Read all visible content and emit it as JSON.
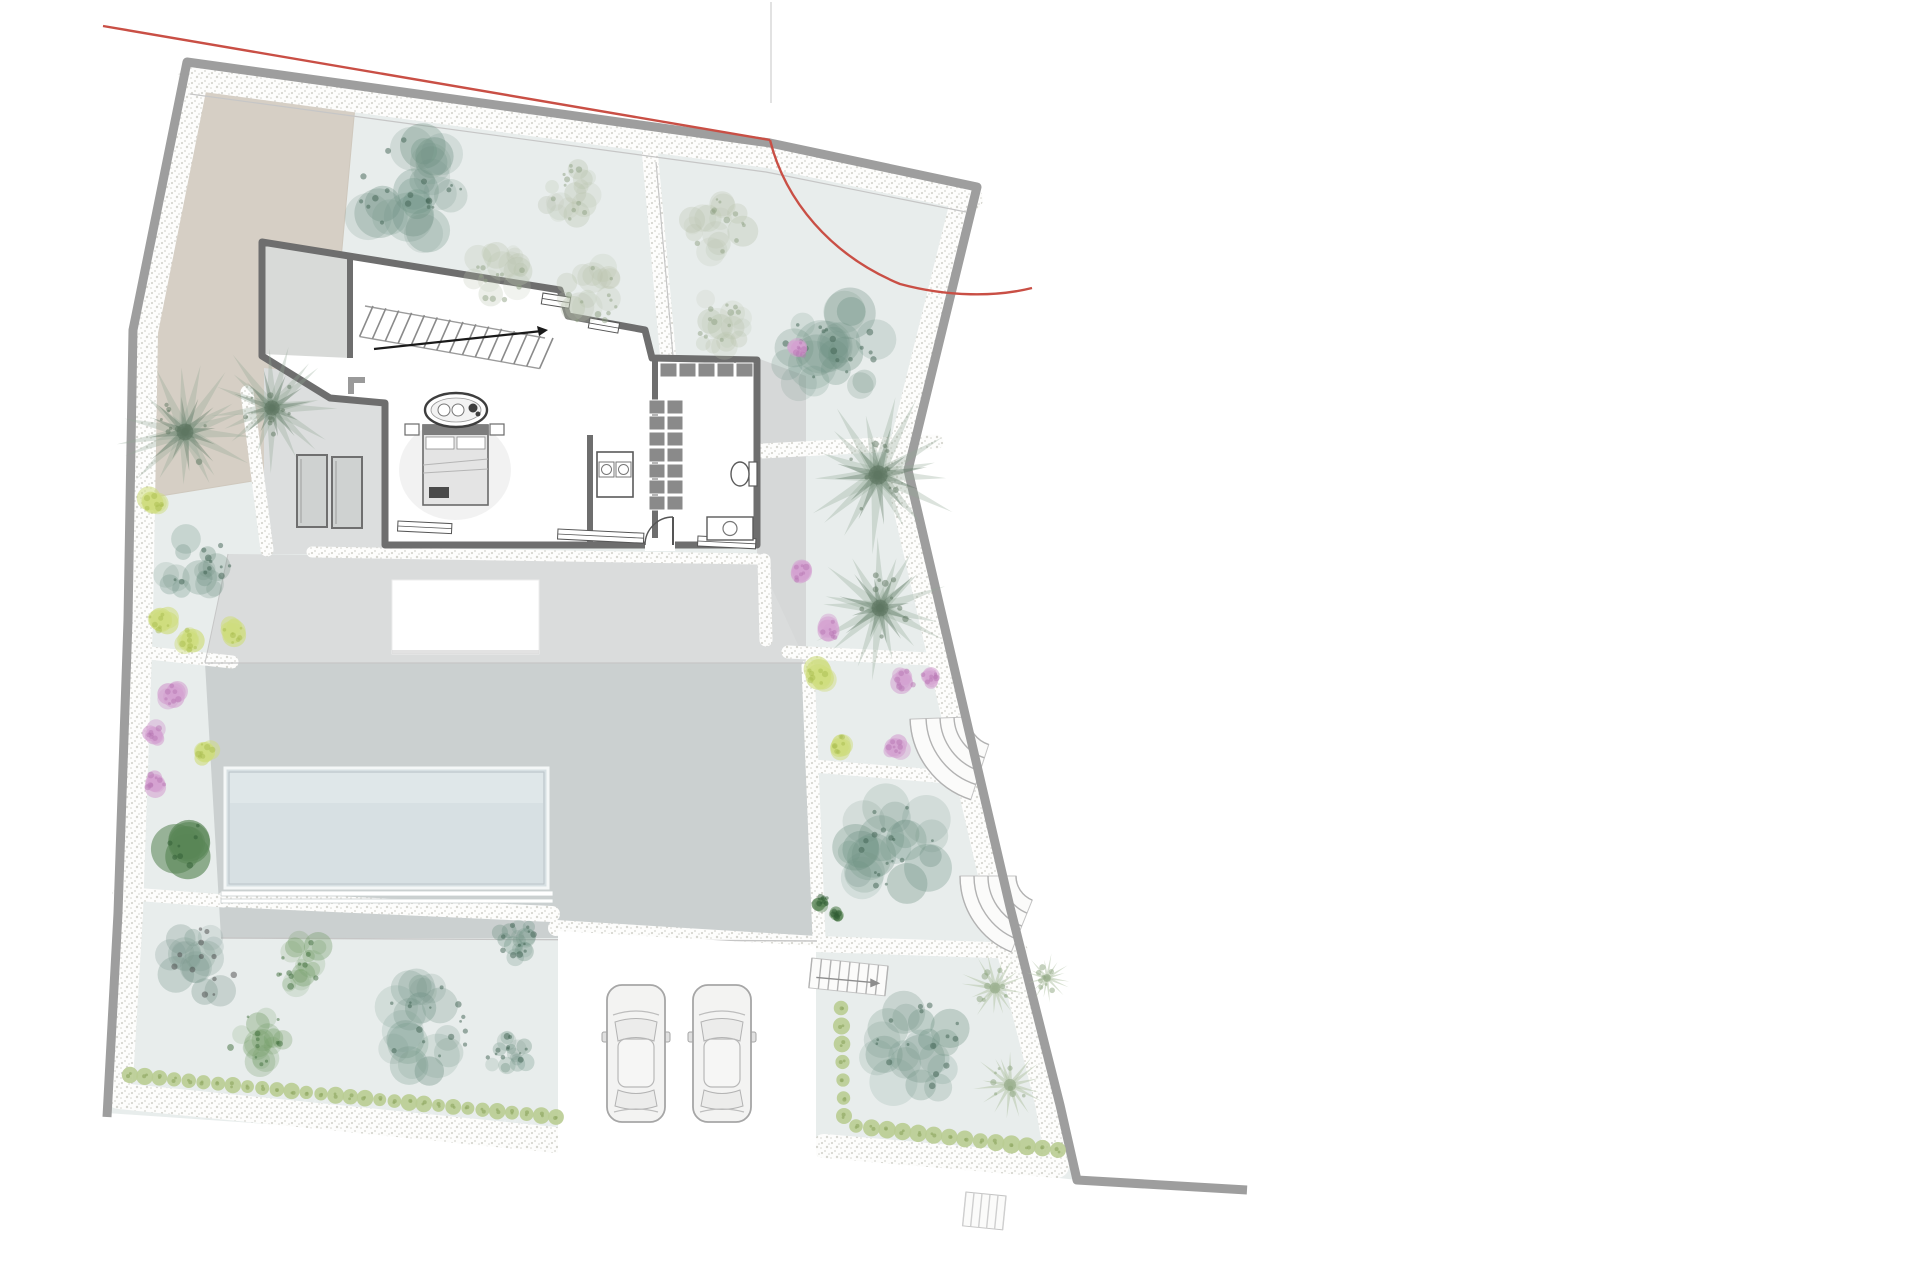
{
  "meta": {
    "title": "villa-site-plan",
    "canvas": {
      "w": 1920,
      "h": 1280
    }
  },
  "colors": {
    "page": "#ffffff",
    "lawn": "#e8edec",
    "beige": "#d6cfc5",
    "beige_edge": "#cfc8bd",
    "terrace": "#dadcdc",
    "porch": "#dcdede",
    "east_strip": "#d6d8d8",
    "slab": "#cbd0d0",
    "pool_fill": "#d7e0e3",
    "pool_light": "#e3ebed",
    "pool_line": "#b9c3c6",
    "pool_coping": "#c9cfcf",
    "wall": "#9e9e9e",
    "thin": "#c6c6c6",
    "house_wall": "#6e6e6e",
    "furniture": "#565656",
    "closet": "#8a8a8a",
    "red": "#c94f45",
    "gravel_dot": "#d6d6d0",
    "stair_line": "#b2b2b2",
    "car_body": "#f3f3f2",
    "car_line": "#a6a6a6",
    "teal": "#6e9183",
    "teal_dark": "#3f6152",
    "tealgray": "#7b988e",
    "sage": "#b9c3ad",
    "sage_dark": "#8fa183",
    "green": "#6f9a62",
    "green_dark": "#3f6e3c",
    "darkgreen": "#5a8657",
    "darkgreen_dark": "#2f5c33",
    "palm": "#93a796",
    "palm_dark": "#5d7560",
    "palmetto": "#b7c7ab",
    "palmetto_dark": "#8ba37e",
    "yellow": "#cfdd7e",
    "yellow_dark": "#a9bd4f",
    "magenta": "#d4a2d1",
    "magenta_dark": "#b877b4",
    "hedge": "#b9cc92",
    "hedge_dark": "#93ab66"
  },
  "plot": {
    "outline": [
      [
        187,
        62
      ],
      [
        770,
        143
      ],
      [
        977,
        187
      ],
      [
        908,
        470
      ],
      [
        1010,
        907
      ],
      [
        1060,
        1105
      ],
      [
        1077,
        1180
      ],
      [
        826,
        1152
      ],
      [
        558,
        1144
      ],
      [
        107,
        1113
      ],
      [
        118,
        913
      ],
      [
        128,
        620
      ],
      [
        133,
        330
      ]
    ],
    "wall_path": [
      [
        107,
        1117
      ],
      [
        118,
        913
      ],
      [
        128,
        620
      ],
      [
        133,
        330
      ],
      [
        187,
        62
      ],
      [
        770,
        143
      ],
      [
        977,
        187
      ],
      [
        908,
        470
      ],
      [
        1010,
        907
      ],
      [
        1060,
        1105
      ],
      [
        1077,
        1180
      ],
      [
        1247,
        1190
      ]
    ],
    "red_segment": [
      [
        103,
        26
      ],
      [
        770,
        140
      ]
    ],
    "red_curve": "M770,140 C785,200 830,255 900,284 C948,297 996,297 1032,288"
  },
  "areas": {
    "beige": [
      [
        200,
        67
      ],
      [
        357,
        84
      ],
      [
        330,
        380
      ],
      [
        308,
        472
      ],
      [
        148,
        498
      ],
      [
        133,
        335
      ]
    ],
    "upper_terrace": [
      [
        228,
        554
      ],
      [
        800,
        560
      ],
      [
        806,
        663
      ],
      [
        205,
        663
      ]
    ],
    "west_porch": [
      [
        264,
        368
      ],
      [
        383,
        380
      ],
      [
        383,
        554
      ],
      [
        264,
        554
      ]
    ],
    "east_strip": [
      [
        757,
        358
      ],
      [
        806,
        376
      ],
      [
        806,
        662
      ],
      [
        757,
        556
      ]
    ],
    "slab": [
      [
        205,
        663
      ],
      [
        806,
        663
      ],
      [
        817,
        938
      ],
      [
        221,
        938
      ]
    ],
    "parking": [
      [
        558,
        931
      ],
      [
        816,
        946
      ],
      [
        816,
        1245
      ],
      [
        558,
        1245
      ]
    ]
  },
  "pool": {
    "x": 225,
    "y": 768,
    "w": 323,
    "h": 120,
    "coping": [
      [
        221,
        891,
        332,
        5
      ],
      [
        221,
        899,
        332,
        4
      ]
    ]
  },
  "pergola": {
    "x": 392,
    "y": 580,
    "w": 147,
    "h": 74
  },
  "gravel_bands": [
    {
      "pts": [
        [
          190,
          78
        ],
        [
          768,
          156
        ],
        [
          971,
          199
        ]
      ],
      "w": 24
    },
    {
      "pts": [
        [
          197,
          80
        ],
        [
          147,
          332
        ],
        [
          142,
          620
        ],
        [
          132,
          913
        ],
        [
          121,
          1098
        ]
      ],
      "w": 22
    },
    {
      "pts": [
        [
          119,
          1096
        ],
        [
          556,
          1140
        ]
      ],
      "w": 26
    },
    {
      "pts": [
        [
          962,
          198
        ],
        [
          895,
          468
        ],
        [
          996,
          905
        ],
        [
          1046,
          1103
        ],
        [
          1057,
          1166
        ]
      ],
      "w": 22
    },
    {
      "pts": [
        [
          1057,
          1166
        ],
        [
          824,
          1146
        ]
      ],
      "w": 24
    },
    {
      "pts": [
        [
          650,
          154
        ],
        [
          668,
          356
        ]
      ],
      "w": 16
    },
    {
      "pts": [
        [
          655,
          372
        ],
        [
          742,
          452
        ],
        [
          936,
          442
        ]
      ],
      "w": 15
    },
    {
      "pts": [
        [
          788,
          652
        ],
        [
          950,
          660
        ]
      ],
      "w": 13
    },
    {
      "pts": [
        [
          813,
          766
        ],
        [
          973,
          779
        ]
      ],
      "w": 13
    },
    {
      "pts": [
        [
          556,
          928
        ],
        [
          816,
          944
        ],
        [
          1020,
          951
        ]
      ],
      "w": 16
    },
    {
      "pts": [
        [
          225,
          899
        ],
        [
          552,
          914
        ]
      ],
      "w": 16
    },
    {
      "pts": [
        [
          140,
          652
        ],
        [
          232,
          662
        ]
      ],
      "w": 13
    },
    {
      "pts": [
        [
          119,
          893
        ],
        [
          224,
          901
        ]
      ],
      "w": 13
    },
    {
      "pts": [
        [
          312,
          552
        ],
        [
          757,
          559
        ]
      ],
      "w": 11
    },
    {
      "pts": [
        [
          764,
          560
        ],
        [
          766,
          640
        ]
      ],
      "w": 13
    },
    {
      "pts": [
        [
          808,
          666
        ],
        [
          819,
          938
        ]
      ],
      "w": 13
    },
    {
      "pts": [
        [
          247,
          392
        ],
        [
          267,
          550
        ]
      ],
      "w": 13
    }
  ],
  "thin_lines": [
    {
      "pts": [
        [
          190,
          94
        ],
        [
          766,
          172
        ],
        [
          966,
          212
        ]
      ],
      "w": 1.2
    },
    {
      "pts": [
        [
          656,
          162
        ],
        [
          673,
          356
        ]
      ],
      "w": 1.2
    },
    {
      "pts": [
        [
          205,
          663
        ],
        [
          806,
          663
        ]
      ],
      "w": 1.2
    },
    {
      "pts": [
        [
          221,
          938
        ],
        [
          817,
          941
        ]
      ],
      "w": 1.4
    },
    {
      "pts": [
        [
          228,
          554
        ],
        [
          205,
          663
        ]
      ],
      "w": 1.0
    },
    {
      "pts": [
        [
          567,
          947
        ],
        [
          567,
          1130
        ]
      ],
      "w": 1.4
    }
  ],
  "house": {
    "outline": [
      [
        262,
        242
      ],
      [
        560,
        290
      ],
      [
        568,
        316
      ],
      [
        645,
        330
      ],
      [
        652,
        358
      ],
      [
        757,
        360
      ],
      [
        757,
        545
      ],
      [
        385,
        545
      ],
      [
        385,
        403
      ],
      [
        330,
        398
      ],
      [
        262,
        356
      ]
    ],
    "garage": [
      [
        262,
        242
      ],
      [
        350,
        256
      ],
      [
        350,
        358
      ],
      [
        262,
        354
      ]
    ],
    "partitions": [
      [
        [
          350,
          256
        ],
        [
          350,
          358
        ]
      ],
      [
        [
          655,
          360
        ],
        [
          655,
          430
        ]
      ],
      [
        [
          655,
          462
        ],
        [
          655,
          545
        ]
      ],
      [
        [
          590,
          435
        ],
        [
          590,
          545
        ]
      ]
    ],
    "stair": {
      "a": [
        365,
        306
      ],
      "b": [
        545,
        338
      ],
      "w": 31,
      "treads": 14,
      "lean": 8,
      "handrail": [
        [
          374,
          349
        ],
        [
          542,
          331
        ]
      ],
      "arrow": [
        [
          548,
          330
        ],
        [
          537,
          326
        ],
        [
          539,
          336
        ]
      ]
    },
    "north_windows": [
      {
        "x": 543,
        "y": 293,
        "w": 28,
        "h": 11,
        "rot": 9
      },
      {
        "x": 590,
        "y": 318,
        "w": 30,
        "h": 10,
        "rot": 10
      }
    ],
    "south_windows": [
      {
        "x": 398,
        "y": 521,
        "w": 54,
        "h": 10,
        "rot": 2.8
      },
      {
        "x": 558,
        "y": 529,
        "w": 86,
        "h": 10,
        "rot": 2.8
      },
      {
        "x": 698,
        "y": 536,
        "w": 58,
        "h": 10,
        "rot": 2.8
      }
    ],
    "door": {
      "gap": [
        645,
        538,
        30,
        13
      ],
      "arc": "M645,545 A28,28 0 0 1 673,517",
      "leaf": [
        [
          673,
          545
        ],
        [
          673,
          517
        ]
      ]
    },
    "bathtub": {
      "cx": 456,
      "cy": 410,
      "rx": 31,
      "ry": 17
    },
    "bed": {
      "x": 423,
      "y": 425,
      "w": 65,
      "h": 80
    },
    "nightstands": [
      [
        405,
        424,
        14,
        11
      ],
      [
        490,
        424,
        14,
        11
      ]
    ],
    "rug": {
      "cx": 455,
      "cy": 470,
      "rx": 56,
      "ry": 50
    },
    "sofa": [
      [
        348,
        377,
        17,
        6
      ],
      [
        348,
        377,
        6,
        17
      ]
    ],
    "closet_col": {
      "x": 649,
      "y": 400,
      "cols": 2,
      "rows": 7,
      "cw": 18,
      "ch": 16
    },
    "closet_row": {
      "x": 660,
      "y": 363,
      "cols": 5,
      "rows": 1,
      "cw": 19,
      "ch": 16
    },
    "washer": {
      "x": 597,
      "y": 452,
      "w": 36,
      "h": 45
    },
    "vanity": {
      "x": 707,
      "y": 517,
      "w": 46,
      "h": 23
    },
    "toilet": {
      "cx": 740,
      "cy": 474
    },
    "planters": [
      [
        297,
        455,
        30,
        72
      ],
      [
        332,
        457,
        30,
        71
      ]
    ]
  },
  "garden_stairs": [
    {
      "type": "fan",
      "cx": 998,
      "cy": 716,
      "radii": [
        30,
        44,
        58,
        72,
        88
      ],
      "a0": 108,
      "a1": 178
    },
    {
      "type": "fan",
      "cx": 1042,
      "cy": 876,
      "radii": [
        26,
        40,
        54,
        68,
        82
      ],
      "a0": 112,
      "a1": 180
    },
    {
      "type": "straight",
      "a": [
        812,
        958
      ],
      "b": [
        888,
        966
      ],
      "w": 30,
      "treads": 8,
      "arrow": true
    },
    {
      "type": "straight",
      "a": [
        966,
        1192
      ],
      "b": [
        1006,
        1196
      ],
      "w": 34,
      "treads": 5,
      "faint": true
    }
  ],
  "trees": [
    {
      "t": "teal",
      "x": 410,
      "y": 190,
      "r": 66
    },
    {
      "t": "sage",
      "x": 570,
      "y": 190,
      "r": 37
    },
    {
      "t": "sage",
      "x": 495,
      "y": 272,
      "r": 37
    },
    {
      "t": "sage",
      "x": 592,
      "y": 295,
      "r": 38
    },
    {
      "t": "sage",
      "x": 718,
      "y": 228,
      "r": 37
    },
    {
      "t": "sage",
      "x": 722,
      "y": 322,
      "r": 37
    },
    {
      "t": "teal",
      "x": 832,
      "y": 350,
      "r": 64
    },
    {
      "t": "teal",
      "x": 196,
      "y": 565,
      "r": 42
    },
    {
      "t": "tealgray",
      "x": 203,
      "y": 962,
      "r": 44
    },
    {
      "t": "green",
      "x": 303,
      "y": 965,
      "r": 34
    },
    {
      "t": "green",
      "x": 257,
      "y": 1040,
      "r": 37
    },
    {
      "t": "teal",
      "x": 428,
      "y": 1028,
      "r": 58
    },
    {
      "t": "teal",
      "x": 517,
      "y": 940,
      "r": 24
    },
    {
      "t": "teal",
      "x": 508,
      "y": 1055,
      "r": 26
    },
    {
      "t": "teal",
      "x": 895,
      "y": 845,
      "r": 60
    },
    {
      "t": "teal",
      "x": 920,
      "y": 1048,
      "r": 58
    },
    {
      "t": "palmetto",
      "x": 995,
      "y": 988,
      "r": 34
    },
    {
      "t": "palmetto",
      "x": 1010,
      "y": 1085,
      "r": 38
    },
    {
      "t": "palmetto",
      "x": 1047,
      "y": 978,
      "r": 24
    }
  ],
  "palms": [
    {
      "x": 185,
      "y": 432,
      "r": 70
    },
    {
      "x": 272,
      "y": 408,
      "r": 64
    },
    {
      "x": 878,
      "y": 475,
      "r": 80
    },
    {
      "x": 880,
      "y": 608,
      "r": 70
    }
  ],
  "bushes": [
    {
      "c": "yellow",
      "x": 153,
      "y": 503,
      "r": 16
    },
    {
      "c": "yellow",
      "x": 160,
      "y": 620,
      "r": 18
    },
    {
      "c": "yellow",
      "x": 190,
      "y": 640,
      "r": 16
    },
    {
      "c": "yellow",
      "x": 233,
      "y": 633,
      "r": 16
    },
    {
      "c": "yellow",
      "x": 205,
      "y": 752,
      "r": 14
    },
    {
      "c": "yellow",
      "x": 818,
      "y": 677,
      "r": 18
    },
    {
      "c": "yellow",
      "x": 840,
      "y": 747,
      "r": 17
    },
    {
      "c": "magenta",
      "x": 172,
      "y": 695,
      "r": 15
    },
    {
      "c": "magenta",
      "x": 155,
      "y": 735,
      "r": 14
    },
    {
      "c": "magenta",
      "x": 155,
      "y": 783,
      "r": 15
    },
    {
      "c": "magenta",
      "x": 799,
      "y": 348,
      "r": 13
    },
    {
      "c": "magenta",
      "x": 800,
      "y": 572,
      "r": 14
    },
    {
      "c": "magenta",
      "x": 830,
      "y": 630,
      "r": 15
    },
    {
      "c": "magenta",
      "x": 905,
      "y": 680,
      "r": 15
    },
    {
      "c": "magenta",
      "x": 931,
      "y": 676,
      "r": 13
    },
    {
      "c": "magenta",
      "x": 895,
      "y": 748,
      "r": 14
    },
    {
      "c": "darkgreen",
      "x": 188,
      "y": 843,
      "r": 36
    },
    {
      "c": "darkgreen",
      "x": 822,
      "y": 902,
      "r": 10
    },
    {
      "c": "darkgreen",
      "x": 836,
      "y": 916,
      "r": 8
    }
  ],
  "hedges": [
    {
      "a": [
        130,
        1075
      ],
      "b": [
        556,
        1117
      ],
      "n": 30,
      "r": 7.5
    },
    {
      "a": [
        856,
        1126
      ],
      "b": [
        1058,
        1150
      ],
      "n": 14,
      "r": 8
    },
    {
      "a": [
        841,
        1008
      ],
      "b": [
        844,
        1116
      ],
      "n": 7,
      "r": 7.5
    }
  ],
  "cars": [
    {
      "x": 607,
      "y": 985,
      "w": 58,
      "l": 137
    },
    {
      "x": 693,
      "y": 985,
      "w": 58,
      "l": 137
    }
  ],
  "artifact_lines": [
    {
      "pts": [
        [
          771,
          2
        ],
        [
          771,
          103
        ]
      ],
      "w": 2,
      "color": "#e2e2e2"
    }
  ]
}
